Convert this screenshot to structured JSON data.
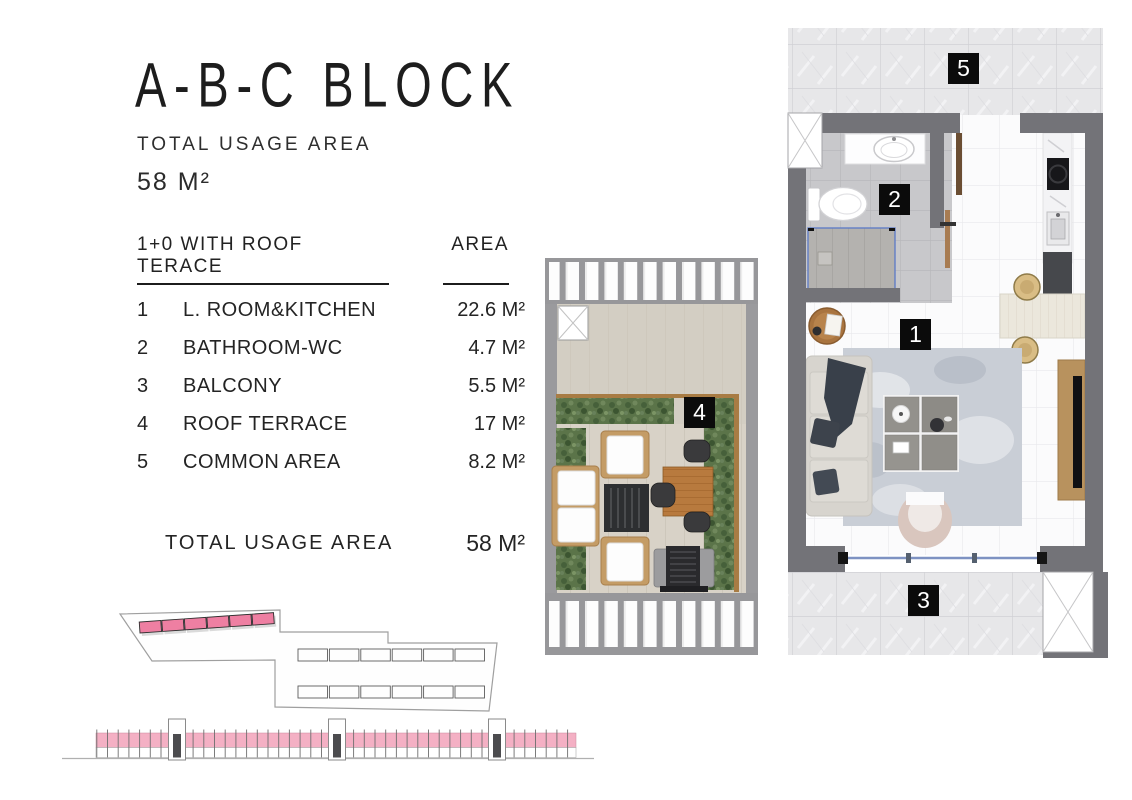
{
  "header": {
    "title": "A-B-C BLOCK",
    "subtitle": "TOTAL USAGE AREA",
    "total_area": "58 M²"
  },
  "table": {
    "col_name": "1+0 WITH ROOF TERACE",
    "col_area": "AREA",
    "rows": [
      {
        "no": "1",
        "name": "L. ROOM&KITCHEN",
        "area": "22.6 M²"
      },
      {
        "no": "2",
        "name": "BATHROOM-WC",
        "area": "4.7 M²"
      },
      {
        "no": "3",
        "name": "BALCONY",
        "area": "5.5 M²"
      },
      {
        "no": "4",
        "name": "ROOF TERRACE",
        "area": "17 M²"
      },
      {
        "no": "5",
        "name": "COMMON AREA",
        "area": "8.2 M²"
      }
    ],
    "total_label": "TOTAL USAGE AREA",
    "total_value": "58 M²"
  },
  "floorplan": {
    "labels": {
      "living": "1",
      "bathroom": "2",
      "balcony": "3",
      "terrace": "4",
      "common": "5"
    }
  },
  "colors": {
    "highlight_pink": "#ee7fa2",
    "elevation_pink": "#f4b0c4",
    "wall_gray": "#737378",
    "label_black": "#0b0b0b"
  }
}
